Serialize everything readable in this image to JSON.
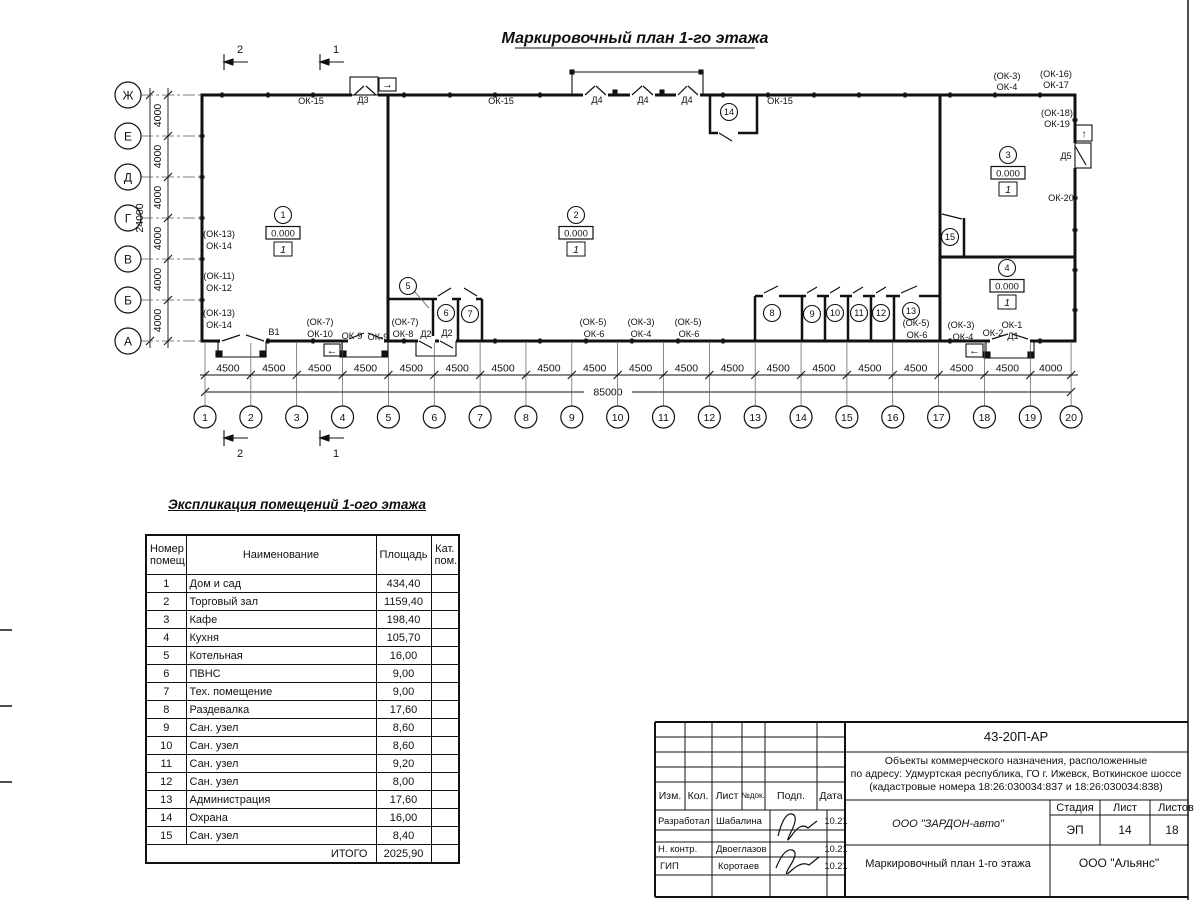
{
  "title": "Маркировочный план 1-го этажа",
  "plan": {
    "section_marks": [
      "2",
      "1"
    ],
    "row_axes": [
      "Ж",
      "Е",
      "Д",
      "Г",
      "В",
      "Б",
      "А"
    ],
    "row_dims": [
      "4000",
      "4000",
      "4000",
      "4000",
      "4000",
      "4000"
    ],
    "row_total": "24000",
    "col_axes": [
      "1",
      "2",
      "3",
      "4",
      "5",
      "6",
      "7",
      "8",
      "9",
      "10",
      "11",
      "12",
      "13",
      "14",
      "15",
      "16",
      "17",
      "18",
      "19",
      "20"
    ],
    "col_dims": [
      "4500",
      "4500",
      "4500",
      "4500",
      "4500",
      "4500",
      "4500",
      "4500",
      "4500",
      "4500",
      "4500",
      "4500",
      "4500",
      "4500",
      "4500",
      "4500",
      "4500",
      "4500",
      "4000"
    ],
    "col_total": "85000",
    "rooms": [
      {
        "num": "1",
        "elevation": "0.000",
        "floor_type": "1"
      },
      {
        "num": "2",
        "elevation": "0.000",
        "floor_type": "1"
      },
      {
        "num": "3",
        "elevation": "0.000",
        "floor_type": "1"
      },
      {
        "num": "4",
        "elevation": "0.000",
        "floor_type": "1"
      },
      {
        "num": "5"
      },
      {
        "num": "6"
      },
      {
        "num": "7"
      },
      {
        "num": "8"
      },
      {
        "num": "9"
      },
      {
        "num": "10"
      },
      {
        "num": "11"
      },
      {
        "num": "12"
      },
      {
        "num": "13"
      },
      {
        "num": "14"
      },
      {
        "num": "15"
      }
    ],
    "wall_labels": [
      "ОК-15",
      "Д3",
      "ОК-15",
      "Д4",
      "Д4",
      "Д4",
      "ОК-15",
      "(ОК-3)",
      "ОК-4",
      "(ОК-16)",
      "ОК-17",
      "(ОК-18)",
      "ОК-19",
      "Д5",
      "ОК-20",
      "(ОК-13)",
      "ОК-14",
      "(ОК-11)",
      "ОК-12",
      "(ОК-13)",
      "ОК-14",
      "В1",
      "(ОК-7)",
      "ОК-10",
      "ОК-9",
      "ОК-9",
      "(ОК-7)",
      "ОК-8",
      "Д2",
      "Д2",
      "(ОК-5)",
      "ОК-6",
      "(ОК-3)",
      "ОК-4",
      "(ОК-5)",
      "ОК-6",
      "(ОК-5)",
      "ОК-6",
      "(ОК-3)",
      "ОК-4",
      "ОК-2",
      "ОК-1",
      "Д1"
    ],
    "icons": {
      "exit_right": "→",
      "exit_left": "←",
      "exit_up": "↑"
    }
  },
  "schedule": {
    "title": "Экспликация помещений 1-ого этажа",
    "headers": [
      "Номер\nпомещ.",
      "Наименование",
      "Площадь",
      "Кат.\nпом."
    ],
    "rows": [
      [
        "1",
        "Дом и сад",
        "434,40"
      ],
      [
        "2",
        "Торговый зал",
        "1159,40"
      ],
      [
        "3",
        "Кафе",
        "198,40"
      ],
      [
        "4",
        "Кухня",
        "105,70"
      ],
      [
        "5",
        "Котельная",
        "16,00"
      ],
      [
        "6",
        "ПВНС",
        "9,00"
      ],
      [
        "7",
        "Тех. помещение",
        "9,00"
      ],
      [
        "8",
        "Раздевалка",
        "17,60"
      ],
      [
        "9",
        "Сан. узел",
        "8,60"
      ],
      [
        "10",
        "Сан. узел",
        "8,60"
      ],
      [
        "11",
        "Сан. узел",
        "9,20"
      ],
      [
        "12",
        "Сан. узел",
        "8,00"
      ],
      [
        "13",
        "Администрация",
        "17,60"
      ],
      [
        "14",
        "Охрана",
        "16,00"
      ],
      [
        "15",
        "Сан. узел",
        "8,40"
      ]
    ],
    "total_label": "ИТОГО",
    "total_value": "2025,90"
  },
  "titleblock": {
    "doc_number": "43-20П-АР",
    "project_lines": [
      "Объекты коммерческого назначения, расположенные",
      "по адресу: Удмуртская республика, ГО г. Ижевск, Воткинское шоссе",
      "(кадастровые номера 18:26:030034:837 и 18:26:030034:838)"
    ],
    "change_headers": [
      "Изм.",
      "Кол.",
      "Лист",
      "№док.",
      "Подп.",
      "Дата"
    ],
    "sign_rows": [
      {
        "role": "Разработал",
        "name": "Шабалина",
        "date": "10.21"
      },
      {
        "role": "Н. контр.",
        "name": "Двоеглазов",
        "date": "10.21"
      },
      {
        "role": "ГИП",
        "name": "Коротаев",
        "date": "10.21"
      }
    ],
    "company": "ООО \"ЗАРДОН-авто\"",
    "stage_label": "Стадия",
    "sheet_label": "Лист",
    "sheets_label": "Листов",
    "stage": "ЭП",
    "sheet": "14",
    "sheets": "18",
    "drawing_title": "Маркировочный план 1-го этажа",
    "contractor": "ООО \"Альянс\""
  }
}
